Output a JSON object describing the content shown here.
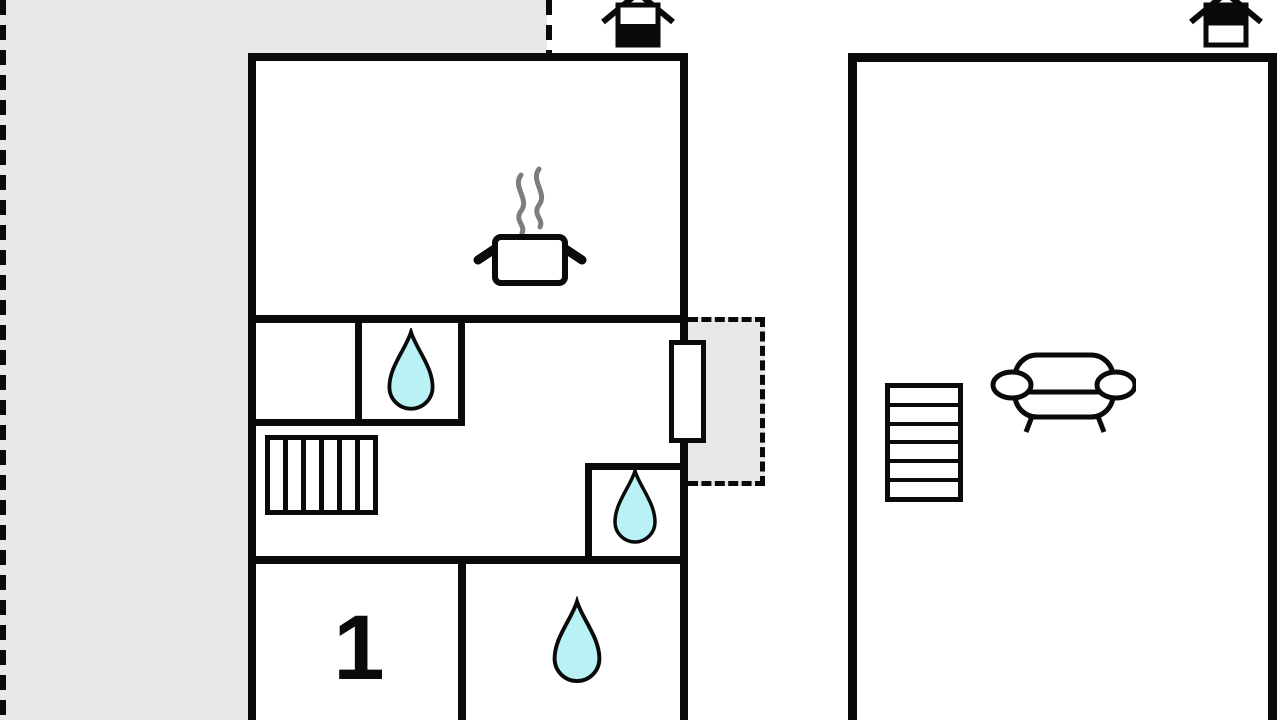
{
  "title": "Holiday home floor plan",
  "colors": {
    "wall": "#0a0a0a",
    "terrace": "#e8e7ea",
    "water_drop_fill": "#b9f1f4",
    "steam": "#7d7d7d",
    "background": "#ffffff"
  },
  "ground_floor": {
    "indicator_icon": "house-ground-floor-icon",
    "room_label": "1",
    "features": [
      "terrace-area",
      "kitchen-pot-icon",
      "water-drop-icon-bathroom-upper",
      "staircase",
      "water-drop-icon-bathroom-mid",
      "water-drop-icon-bathroom-lower",
      "balcony-area",
      "door"
    ]
  },
  "upper_floor": {
    "indicator_icon": "house-upper-floor-icon",
    "features": [
      "staircase",
      "sofa-icon"
    ]
  }
}
